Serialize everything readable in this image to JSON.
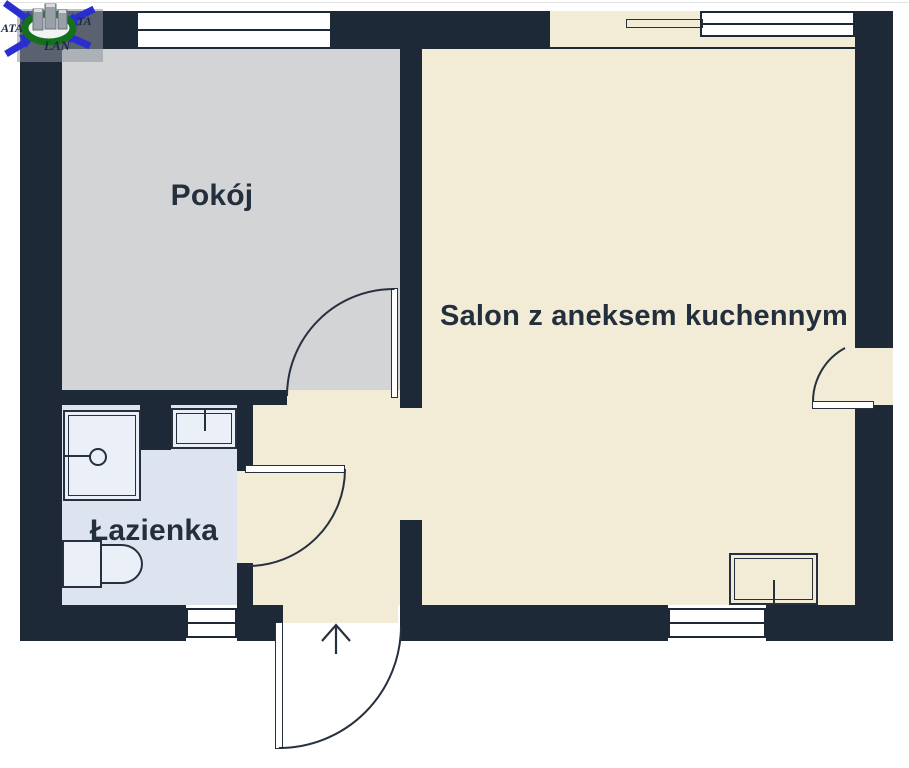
{
  "plan": {
    "rooms": [
      {
        "id": "pokoj",
        "label": "Pokój"
      },
      {
        "id": "salon",
        "label": "Salon z aneksem kuchennym"
      },
      {
        "id": "lazienka",
        "label": "Łazienka"
      }
    ],
    "doors": [
      "entrance-door",
      "pokoj-door",
      "lazienka-door",
      "balcony-door"
    ],
    "windows_count": 4,
    "fixtures": [
      "shower-icon",
      "sink-icon",
      "toilet-icon",
      "kitchen-sink-icon"
    ],
    "entrance_marker": "arrow-up",
    "colors": {
      "wall": "#1e2938",
      "pokoj_floor": "#d3d4d6",
      "salon_floor": "#f2ebd5",
      "lazienka_floor": "#dde3ef",
      "fixture_fill": "#ebeff8",
      "label_text": "#242f3e"
    }
  },
  "logo": {
    "text_left": "ATA",
    "text_right": "TA",
    "text_bottom": "LAN",
    "arrow_color": "#2a2ed0",
    "ring_color": "#15701d"
  }
}
